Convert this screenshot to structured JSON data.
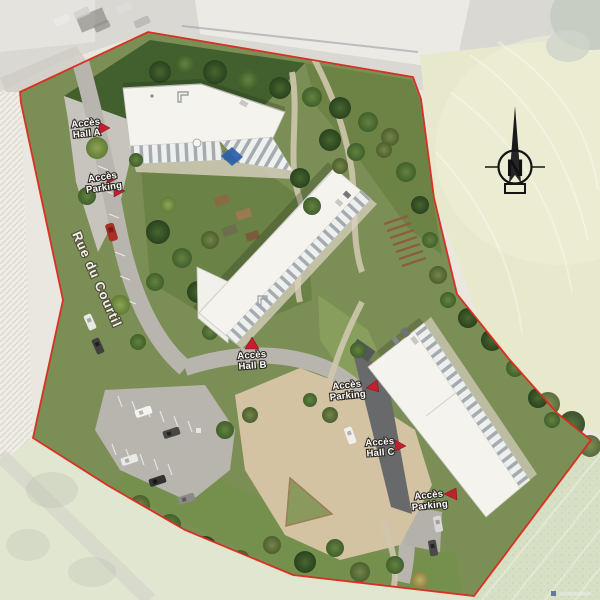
{
  "plan": {
    "type": "residential-development-aerial-site-plan",
    "labels": {
      "hall_a": {
        "line1": "Accès",
        "line2": "Hall A",
        "marker": "red-arrow-right"
      },
      "parking_a": {
        "line1": "Accès",
        "line2": "Parking",
        "marker": "red-arrow-right-double"
      },
      "hall_b": {
        "line1": "Accès",
        "line2": "Hall B",
        "marker": "red-triangle-up"
      },
      "parking_c_upper": {
        "line1": "Accès",
        "line2": "Parking",
        "marker": "red-triangle-left"
      },
      "hall_c": {
        "line1": "Accès",
        "line2": "Hall C",
        "marker": "red-arrow-right"
      },
      "parking_c_lower": {
        "line1": "Accès",
        "line2": "Parking",
        "marker": "red-triangle-left"
      }
    },
    "street": {
      "name": "Rue du Courtil"
    },
    "compass": {
      "north_label": "N"
    },
    "colors": {
      "boundary_red": "#da2a1c",
      "marker_red": "#c2202e",
      "roof_white": "#f4f3ee",
      "lawn_dark": "#42602e",
      "site_green": "#7b8e55",
      "road_gray": "#b8b5ae",
      "plaza_tan": "#d4c3a2",
      "faded_field": "#e7e8cc",
      "sail_blue": "#2d5fae"
    }
  }
}
